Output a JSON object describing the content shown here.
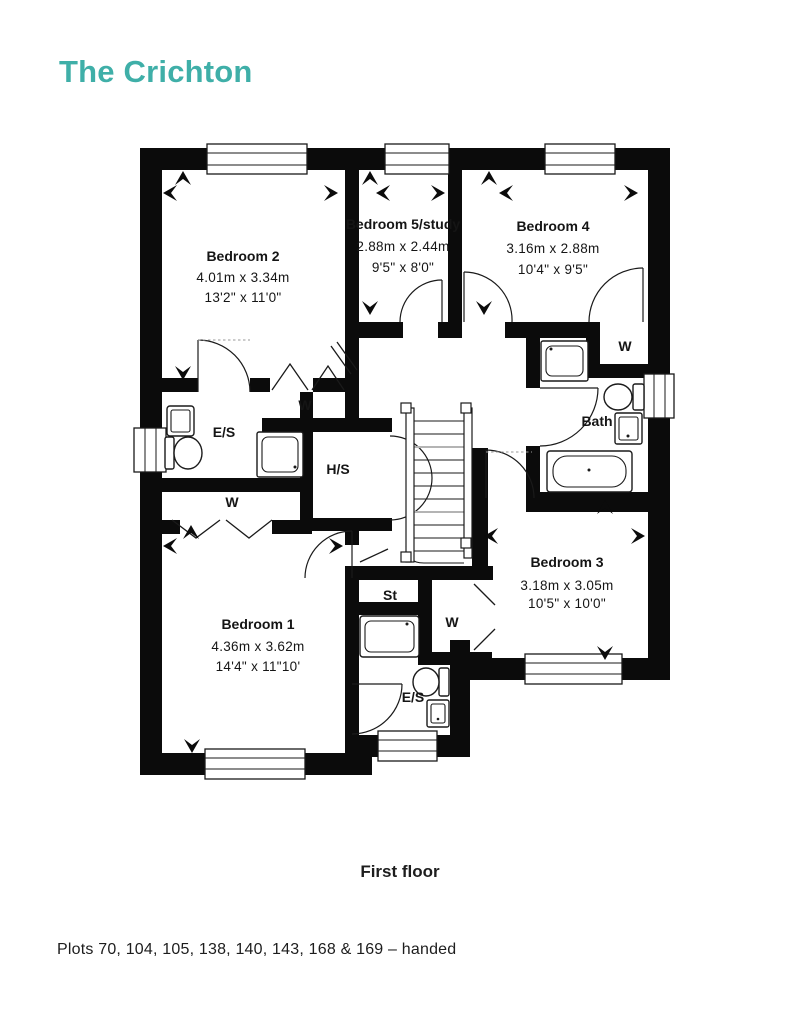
{
  "title": "The Crichton",
  "brand_color": "#3FAFA8",
  "floor_label": "First floor",
  "footer_note": "Plots 70, 104, 105, 138, 140, 143, 168 & 169 – handed",
  "rooms": [
    {
      "name": "Bedroom 2",
      "metric": "4.01m x 3.34m",
      "imperial": "13'2\" x 11'0\""
    },
    {
      "name": "Bedroom 5/study",
      "metric": "2.88m x 2.44m",
      "imperial": "9'5\" x 8'0\""
    },
    {
      "name": "Bedroom 4",
      "metric": "3.16m x 2.88m",
      "imperial": "10'4\" x 9'5\""
    },
    {
      "name": "Bedroom 1",
      "metric": "4.36m x 3.62m",
      "imperial": "14'4\" x 11\"10'"
    },
    {
      "name": "Bedroom 3",
      "metric": "3.18m x 3.05m",
      "imperial": "10'5\" x 10'0\""
    }
  ],
  "labels": {
    "ensuite": "E/S",
    "wardrobe": "W",
    "hot_store": "H/S",
    "store": "St",
    "bath": "Bath"
  }
}
